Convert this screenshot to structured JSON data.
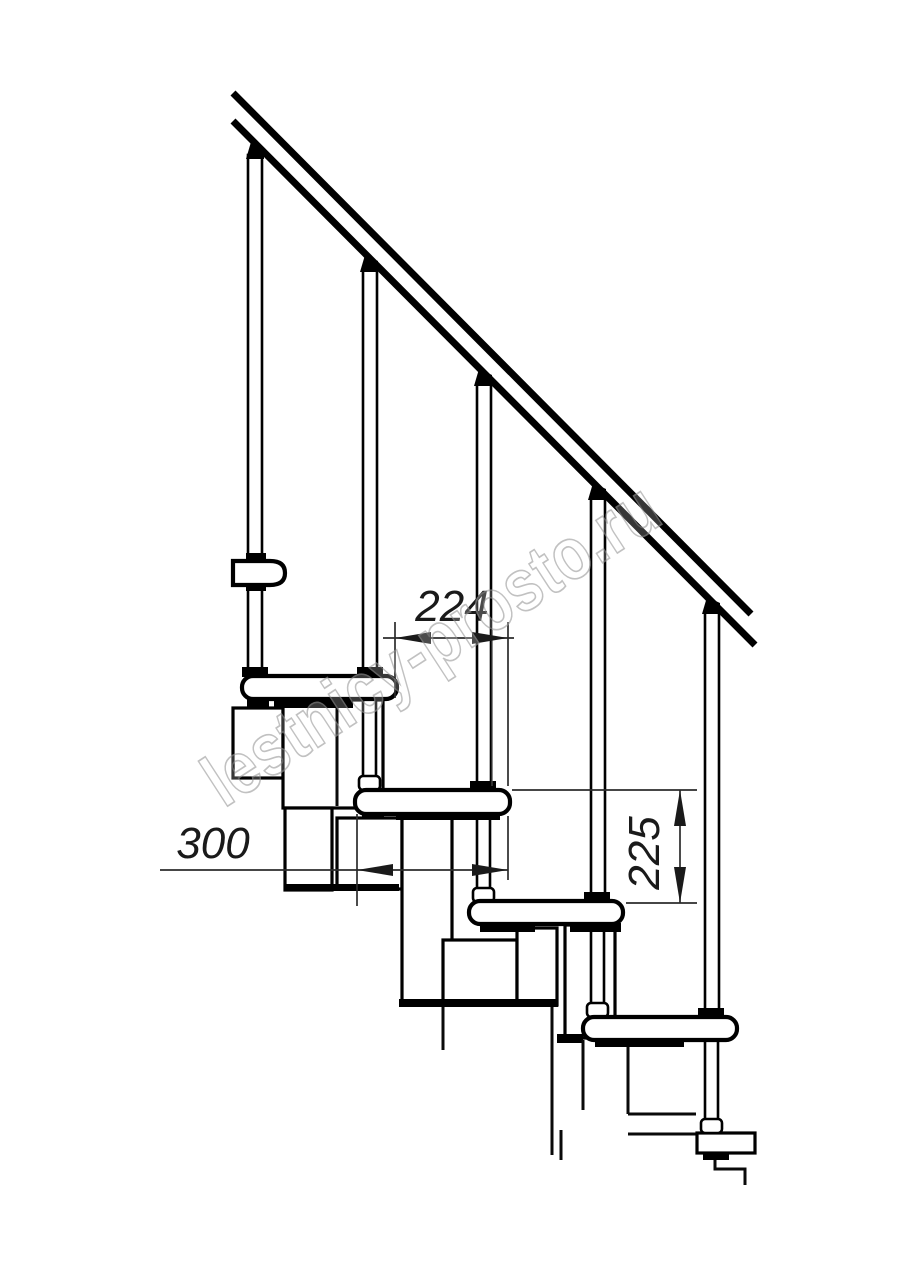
{
  "drawing": {
    "watermark": "lestnicy-prosto.ru",
    "dimensions": {
      "run": "224",
      "tread_depth": "300",
      "rise": "225"
    },
    "colors": {
      "line": "#000000",
      "dimension": "#2b2b2b",
      "background": "#ffffff",
      "watermark_outline": "#9c9c9c"
    }
  }
}
